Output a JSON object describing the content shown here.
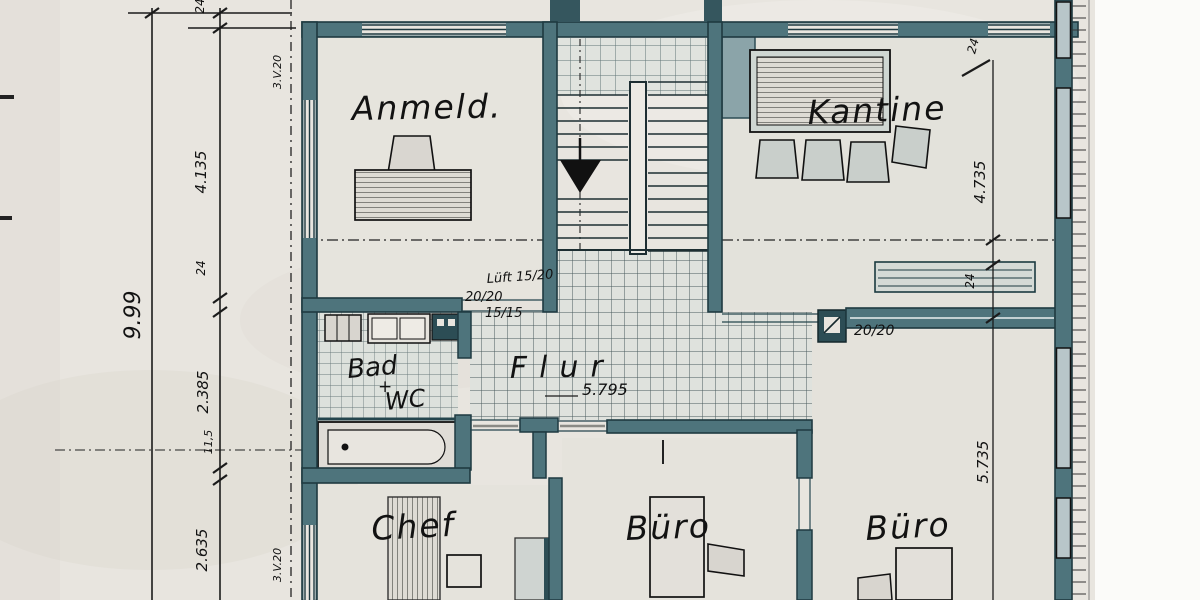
{
  "plan": {
    "rooms": {
      "anmeld": {
        "label": "Anmeld."
      },
      "kantine": {
        "label": "Kantine"
      },
      "flur": {
        "label": "Flur",
        "dimension": "5.795"
      },
      "bad": {
        "label_line1": "Bad",
        "connector": "+",
        "label_line2": "WC"
      },
      "chef": {
        "label": "Chef"
      },
      "buero_mitte": {
        "label": "Büro"
      },
      "buero_rechts": {
        "label": "Büro"
      }
    },
    "dimensions_left": {
      "total": "9.99",
      "wall_top": "24",
      "seg1": "4.135",
      "wall_mid": "24",
      "seg2": "2.385",
      "wall_thin": "11,5",
      "seg3": "2.635",
      "axis_top": "3.V.20",
      "axis_bottom": "3.V.20"
    },
    "dimensions_right": {
      "wall_top": "24",
      "seg1": "4.735",
      "wall_mid": "24",
      "seg2": "5.735"
    },
    "annotations": {
      "vent": "Lüft 15/20",
      "duct1": "20/20",
      "duct2": "15/15",
      "column": "20/20"
    },
    "colors": {
      "paper": "#e8e5df",
      "wall": "#4e747c",
      "ink": "#1e3a41",
      "black": "#121212"
    }
  }
}
